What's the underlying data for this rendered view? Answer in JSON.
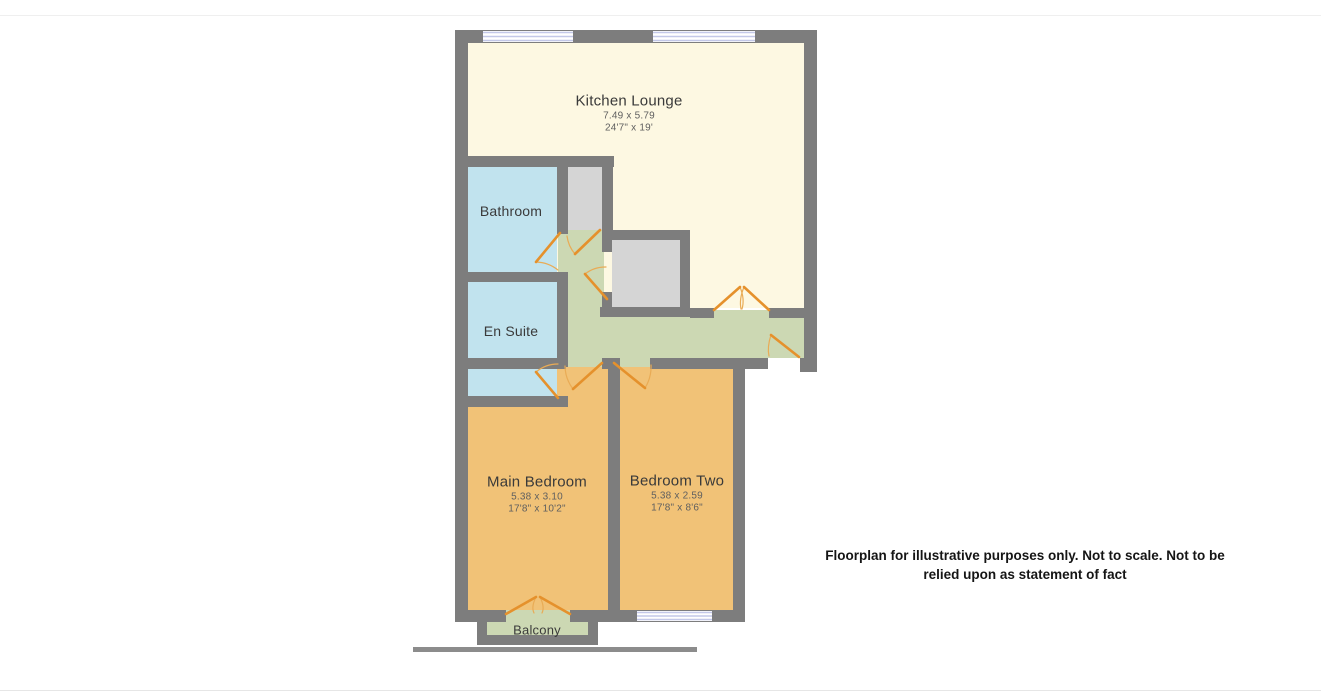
{
  "palette": {
    "wall": "#7d7d7d",
    "kitchen": "#fdf8e2",
    "bathroom": "#c1e3ee",
    "bedroom": "#f1c277",
    "hall": "#ccd8b3",
    "storage": "#d5d5d5",
    "door": "#e5912c",
    "window_line": "#c3c8e8",
    "ground": "#8c8c8c"
  },
  "rooms": {
    "kitchen_lounge": {
      "label": "Kitchen Lounge",
      "dims_m": "7.49 x 5.79",
      "dims_ft": "24'7\" x 19'"
    },
    "bathroom": {
      "label": "Bathroom"
    },
    "en_suite": {
      "label": "En Suite"
    },
    "main_bedroom": {
      "label": "Main Bedroom",
      "dims_m": "5.38 x 3.10",
      "dims_ft": "17'8\" x 10'2\""
    },
    "bedroom_two": {
      "label": "Bedroom Two",
      "dims_m": "5.38 x 2.59",
      "dims_ft": "17'8\" x 8'6\""
    },
    "balcony": {
      "label": "Balcony"
    }
  },
  "disclaimer": {
    "text": "Floorplan for illustrative purposes only. Not to scale. Not to be relied upon as statement of fact"
  }
}
